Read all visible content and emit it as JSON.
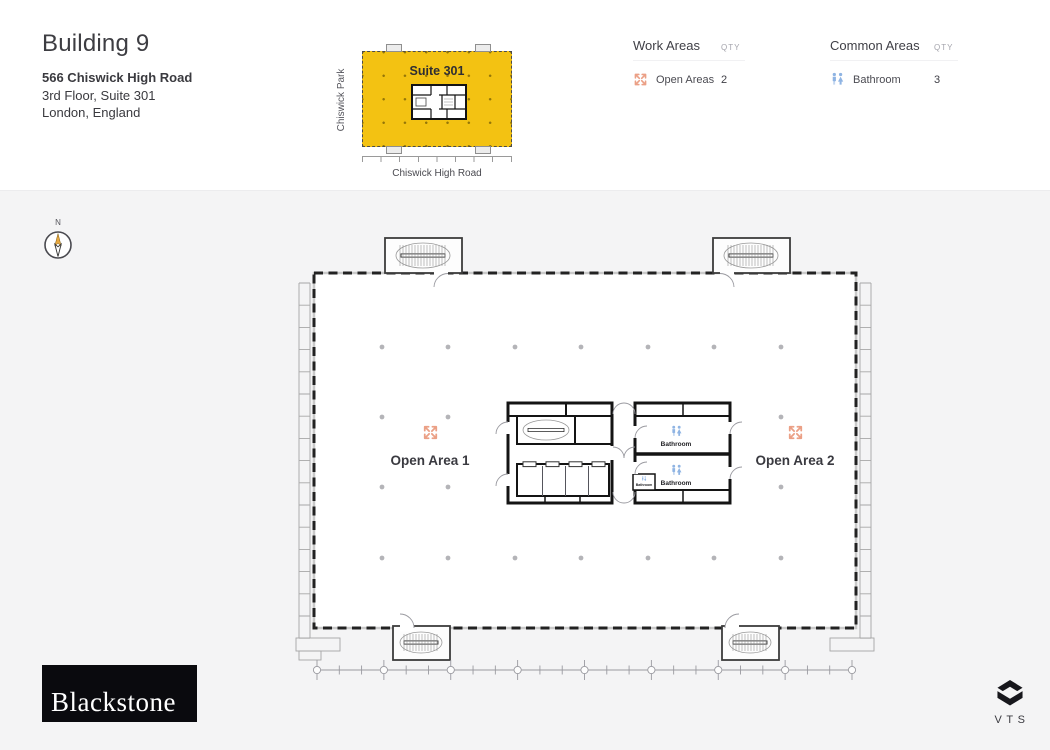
{
  "header": {
    "building": "Building 9",
    "address": "566 Chiswick High Road",
    "floor_suite": "3rd Floor, Suite 301",
    "city": "London, England"
  },
  "minimap": {
    "suite_label": "Suite 301",
    "left_street": "Chiswick Park",
    "bottom_street": "Chiswick High Road",
    "highlight_color": "#F3C212"
  },
  "legend": {
    "work_areas": {
      "title": "Work Areas",
      "qty_header": "QTY",
      "items": [
        {
          "icon": "expand-arrows-icon",
          "label": "Open Areas",
          "qty": "2",
          "color": "#EBA086"
        }
      ]
    },
    "common_areas": {
      "title": "Common Areas",
      "qty_header": "QTY",
      "items": [
        {
          "icon": "restroom-icon",
          "label": "Bathroom",
          "qty": "3",
          "color": "#8FB4E3"
        }
      ]
    }
  },
  "compass": {
    "north_label": "N"
  },
  "floorplan": {
    "open_areas": [
      {
        "label": "Open Area 1"
      },
      {
        "label": "Open Area 2"
      }
    ],
    "bathrooms": [
      {
        "label": "Bathroom"
      },
      {
        "label": "Bathroom"
      },
      {
        "label": "Bathroom"
      }
    ]
  },
  "footer": {
    "brand": "Blackstone",
    "platform": "VTS"
  }
}
